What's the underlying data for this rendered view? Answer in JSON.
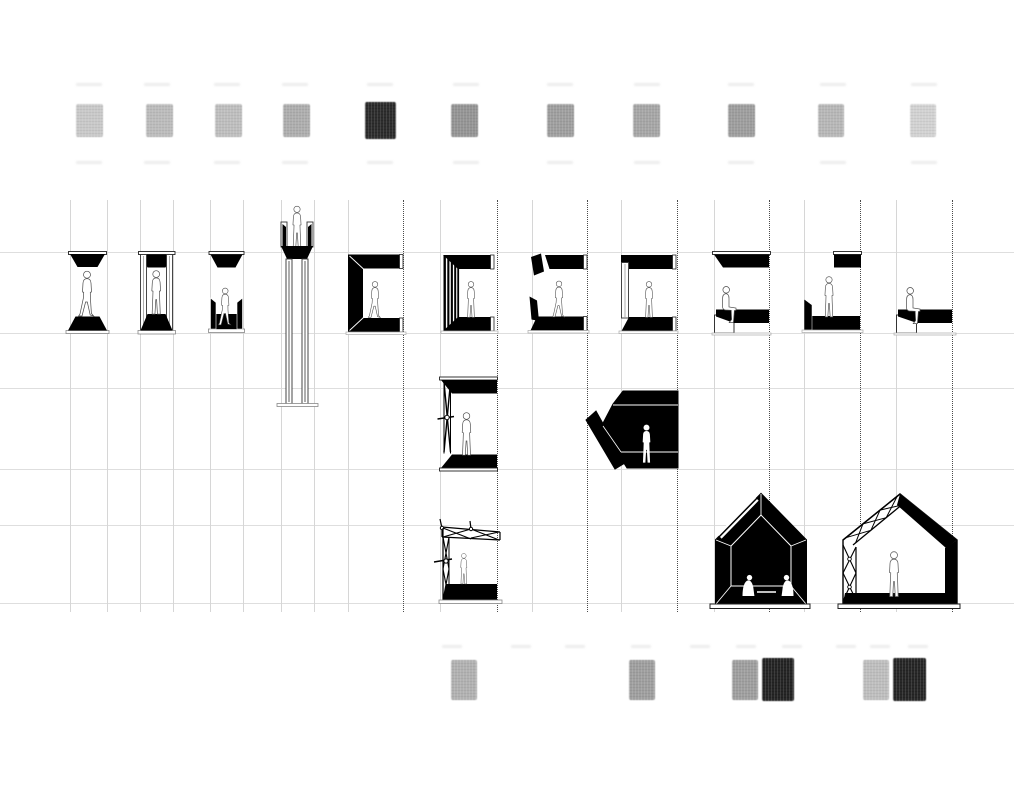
{
  "canvas": {
    "w": 1024,
    "h": 791,
    "bg": "#ffffff"
  },
  "palette": {
    "ink": "#000000",
    "paper": "#ffffff",
    "grid_line": "#dedede",
    "guide_line": "#d6d6d6",
    "dotted_guide": "#4a4a4a",
    "figure_outline": "#4a4a4a",
    "baseline": "#999999"
  },
  "grid": {
    "h_extent": 1014,
    "guide_top": 200,
    "guide_bottom": 612,
    "h_lines": [
      252,
      333,
      388,
      469,
      525,
      603
    ],
    "v_guides": [
      {
        "x": 70,
        "dotted": false
      },
      {
        "x": 107,
        "dotted": false
      },
      {
        "x": 140,
        "dotted": false
      },
      {
        "x": 173,
        "dotted": false
      },
      {
        "x": 210,
        "dotted": false
      },
      {
        "x": 243,
        "dotted": false
      },
      {
        "x": 281,
        "dotted": false
      },
      {
        "x": 314,
        "dotted": false
      },
      {
        "x": 348,
        "dotted": false
      },
      {
        "x": 403,
        "dotted": true
      },
      {
        "x": 440,
        "dotted": false
      },
      {
        "x": 497,
        "dotted": true
      },
      {
        "x": 532,
        "dotted": false
      },
      {
        "x": 587,
        "dotted": true
      },
      {
        "x": 621,
        "dotted": false
      },
      {
        "x": 677,
        "dotted": true
      },
      {
        "x": 714,
        "dotted": false
      },
      {
        "x": 769,
        "dotted": true
      },
      {
        "x": 804,
        "dotted": false
      },
      {
        "x": 860,
        "dotted": true
      },
      {
        "x": 896,
        "dotted": false
      },
      {
        "x": 952,
        "dotted": true
      }
    ]
  },
  "ghost_marks": {
    "rows": [
      {
        "y": 83,
        "w": 26,
        "xs": [
          89,
          157,
          227,
          295,
          380,
          466,
          560,
          647,
          741,
          833,
          924
        ]
      },
      {
        "y": 161,
        "w": 26,
        "xs": [
          89,
          157,
          227,
          295,
          380,
          466,
          560,
          647,
          741,
          833,
          924
        ]
      },
      {
        "y": 645,
        "w": 20,
        "xs": [
          452,
          521,
          575,
          641,
          700,
          746,
          792,
          846,
          880,
          918
        ]
      }
    ]
  },
  "top_swatches": [
    {
      "x": 76,
      "y": 104,
      "w": 27,
      "h": 33,
      "color": "#c8c8c8"
    },
    {
      "x": 146,
      "y": 104,
      "w": 27,
      "h": 33,
      "color": "#b9b9b9"
    },
    {
      "x": 215,
      "y": 104,
      "w": 27,
      "h": 33,
      "color": "#bcbcbc"
    },
    {
      "x": 283,
      "y": 104,
      "w": 27,
      "h": 33,
      "color": "#a9a9a9"
    },
    {
      "x": 365,
      "y": 102,
      "w": 31,
      "h": 37,
      "color": "#161616"
    },
    {
      "x": 451,
      "y": 104,
      "w": 27,
      "h": 33,
      "color": "#8d8d8d"
    },
    {
      "x": 547,
      "y": 104,
      "w": 27,
      "h": 33,
      "color": "#989898"
    },
    {
      "x": 633,
      "y": 104,
      "w": 27,
      "h": 33,
      "color": "#a0a0a0"
    },
    {
      "x": 728,
      "y": 104,
      "w": 27,
      "h": 33,
      "color": "#979797"
    },
    {
      "x": 818,
      "y": 104,
      "w": 26,
      "h": 33,
      "color": "#b4b4b4"
    },
    {
      "x": 910,
      "y": 104,
      "w": 26,
      "h": 33,
      "color": "#d3d3d3"
    }
  ],
  "bottom_swatches": [
    {
      "x": 451,
      "y": 660,
      "w": 26,
      "h": 40,
      "color": "#adadad"
    },
    {
      "x": 629,
      "y": 660,
      "w": 26,
      "h": 40,
      "color": "#989898"
    },
    {
      "x": 732,
      "y": 660,
      "w": 26,
      "h": 40,
      "color": "#989898"
    },
    {
      "x": 762,
      "y": 658,
      "w": 32,
      "h": 43,
      "color": "#0e0e0e"
    },
    {
      "x": 863,
      "y": 660,
      "w": 26,
      "h": 40,
      "color": "#bcbcbc"
    },
    {
      "x": 893,
      "y": 658,
      "w": 33,
      "h": 43,
      "color": "#101010"
    }
  ],
  "structures": [
    {
      "id": "s1",
      "label": "canopy over plinth section with walking figure"
    },
    {
      "id": "s2",
      "label": "portal frame section with standing figure"
    },
    {
      "id": "s3",
      "label": "canopy over trough section with figure"
    },
    {
      "id": "s4",
      "label": "elevated lookout tower with figure on top"
    },
    {
      "id": "s5",
      "label": "c-shaped enclosure section with walking figure"
    },
    {
      "id": "s6",
      "label": "louvered c-enclosure section with standing figure"
    },
    {
      "id": "s7",
      "label": "split c-enclosure fragments with walking figure"
    },
    {
      "id": "s8",
      "label": "thin-wall c-enclosure section with standing figure"
    },
    {
      "id": "s9",
      "label": "floating canopy over bench with seated figure"
    },
    {
      "id": "s10",
      "label": "low wall and offset canopy with standing figure"
    },
    {
      "id": "s11",
      "label": "bench slab with seated figure"
    },
    {
      "id": "r2s1",
      "label": "x-braced enclosure section with standing figure"
    },
    {
      "id": "r2s2",
      "label": "faceted dark shelter with standing silhouette"
    },
    {
      "id": "r3s1",
      "label": "truss frame pavilion with standing figure"
    },
    {
      "id": "r3s2",
      "label": "solid gable house with two seated silhouettes"
    },
    {
      "id": "r3s3",
      "label": "truss gable house with standing figure"
    }
  ]
}
